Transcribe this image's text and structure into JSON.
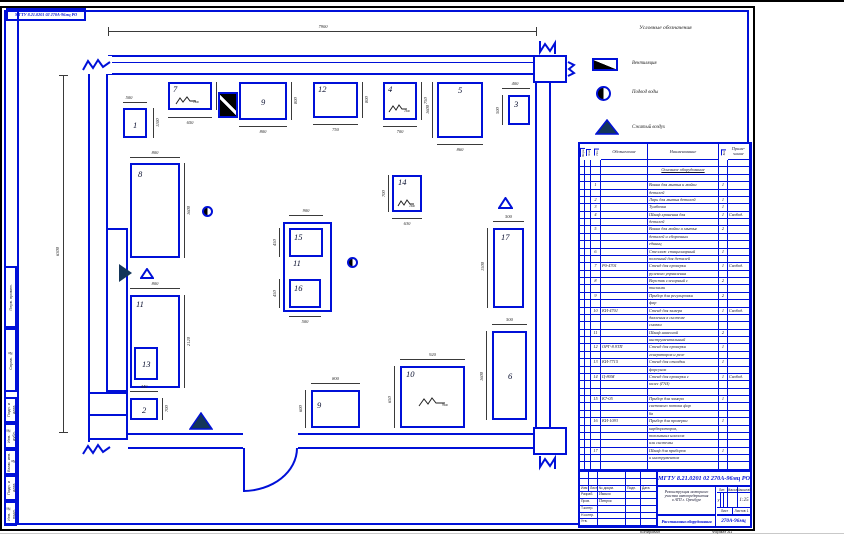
{
  "sheet": {
    "corner_stamp": "МГТУ 8.21.0201 02 270А-96мц РО",
    "footer_copy": "Копировал",
    "footer_format": "Формат А1",
    "side_upper": [
      "Перв. примен.",
      "Справ. №"
    ],
    "side_lower": [
      "Подп. и дата",
      "Инв. № дубл.",
      "Взам. инв. №",
      "Подп. и дата",
      "Инв. № подл."
    ]
  },
  "legend": {
    "title": "Условные обозначения",
    "items": [
      {
        "icon": "sink-symbol",
        "label": "Вентиляция"
      },
      {
        "icon": "water-supply-symbol",
        "label": "Подвод воды"
      },
      {
        "icon": "compressed-air-symbol",
        "label": "Сжатый воздух"
      },
      {
        "icon": "fire-extinguisher-symbol",
        "label": "Огнетушитель"
      },
      {
        "icon": "power-consumer-symbol",
        "label": "Потребители электроэнергии"
      }
    ]
  },
  "plan": {
    "dim_top": "7900",
    "dim_left": "6300",
    "items": {
      "i1": {
        "num": "1",
        "dim_top": "500",
        "dim_right": "1100"
      },
      "i7": {
        "num": "7",
        "power": "1кв",
        "dim_bottom": "650",
        "dim_right": "750"
      },
      "i9t": {
        "num": "9",
        "dim_bottom": "800",
        "dim_right": "800"
      },
      "i12": {
        "num": "12",
        "dim_bottom": "750",
        "dim_right": "800"
      },
      "i4": {
        "num": "4",
        "power": "1кв",
        "dim_bottom": "700",
        "dim_right": "750"
      },
      "i5": {
        "num": "5",
        "dim_bottom": "860",
        "dim_left": "1600"
      },
      "i3": {
        "num": "3",
        "dim_top": "400",
        "dim_left": "500"
      },
      "i8": {
        "num": "8",
        "dim_top": "800",
        "dim_right": "1600"
      },
      "i11L": {
        "num": "11",
        "dim_top": "800",
        "dim_right": "2120"
      },
      "i13": {
        "num": "13"
      },
      "i2": {
        "num": "2",
        "dim_top": "440",
        "dim_right": "700"
      },
      "i11C": {
        "num": "11",
        "dim_top": "900",
        "dim_bottom": "500"
      },
      "i15": {
        "num": "15",
        "dim_left": "450"
      },
      "i16": {
        "num": "16",
        "dim_left": "450"
      },
      "i14": {
        "num": "14",
        "power": "1кв",
        "dim_left": "700",
        "dim_bottom": "630"
      },
      "i17": {
        "num": "17",
        "dim_top": "500",
        "dim_left": "1500"
      },
      "i6": {
        "num": "6",
        "dim_top": "500",
        "dim_left": "1600"
      },
      "i9b": {
        "num": "9",
        "dim_top": "800",
        "dim_left": "600"
      },
      "i10": {
        "num": "10",
        "power": "9кв",
        "dim_top": "920",
        "dim_left": "650"
      }
    }
  },
  "spec_table": {
    "headers": {
      "c1": "Форм.",
      "c2": "Зона",
      "c3": "Поз.",
      "code": "Обозначение",
      "name": "Наименование",
      "qty": "Кол.",
      "note": "Приме-чание"
    },
    "rows": [
      {},
      {
        "section": "Основное оборудование"
      },
      {},
      {
        "p": "1",
        "n": "Ванна для мытья и мойки",
        "q": "1"
      },
      {
        "n": "деталей"
      },
      {
        "p": "2",
        "n": "Ларь для мытья деталей",
        "q": "1"
      },
      {
        "p": "3",
        "n": "Тумбочка",
        "q": "1"
      },
      {
        "p": "4",
        "n": "Шкаф хранения для",
        "q": "1",
        "t": "Свобод."
      },
      {
        "n": "деталей"
      },
      {
        "p": "5",
        "n": "Ванна для мойки и мытья",
        "q": "2"
      },
      {
        "n": "деталей и сборочных"
      },
      {
        "n": "единиц"
      },
      {
        "p": "6",
        "n": "Стеллаж стационарный",
        "q": "1"
      },
      {
        "n": "полочный для деталей"
      },
      {
        "p": "7",
        "c": "Р0-4701",
        "n": "Стенд для проверки",
        "q": "1",
        "t": "Свобод."
      },
      {
        "n": "рулевого управления"
      },
      {
        "p": "8",
        "n": "Верстак слесарный с",
        "q": "2"
      },
      {
        "n": "тисками"
      },
      {
        "p": "9",
        "n": "Прибор для регулировки",
        "q": "2"
      },
      {
        "n": "фар"
      },
      {
        "p": "10",
        "c": "КИ-4701",
        "n": "Стенд для замера",
        "q": "1",
        "t": "Свобод."
      },
      {
        "n": "давления в системе"
      },
      {
        "n": "смазки"
      },
      {
        "p": "11",
        "n": "Шкаф навесной",
        "q": "2"
      },
      {
        "n": "инструментальный"
      },
      {
        "p": "12",
        "c": "ОРГ-8.9ТП",
        "n": "Стенд для проверки",
        "q": "1"
      },
      {
        "n": "генераторов и реле"
      },
      {
        "p": "13",
        "c": "КИ-7715",
        "n": "Стенд для отладки",
        "q": "1"
      },
      {
        "n": "форсунок"
      },
      {
        "p": "14",
        "c": "Ц-80М",
        "n": "Стенд для проверки с",
        "q": "1",
        "t": "Свобод."
      },
      {
        "n": "колес (ГАЗ)"
      },
      {},
      {
        "p": "15",
        "c": "К7-05",
        "n": "Прибор для замера",
        "q": "1"
      },
      {
        "n": "светового потока фар"
      },
      {
        "n": "6в"
      },
      {
        "p": "16",
        "c": "КИ-1093",
        "n": "Прибор для проверки",
        "q": "1"
      },
      {
        "n": "карбюраторов,"
      },
      {
        "n": "топливных насосов"
      },
      {
        "n": "или системы"
      },
      {
        "p": "17",
        "n": "Шкаф для приборов",
        "q": "1"
      },
      {
        "n": "и инструментов"
      },
      {}
    ]
  },
  "title_block": {
    "doc_number": "МГТУ 8.21.0201 02 270А-96мц РО",
    "description": [
      "Реконструкция моторного",
      "участка автопредприятия",
      "в АТП г. Оренбург"
    ],
    "doc_title": "Расстановка оборудования",
    "group": "270А-96мц",
    "lit_label": "Лит.",
    "lit_value": "у",
    "mass_label": "Масса",
    "scale_label": "Масштаб",
    "scale_value": "1:25",
    "sheet_label": "Лист",
    "sheets_label": "Листов",
    "sheets_value": "1",
    "sig_rows": [
      [
        "Изм",
        "Лист",
        "№ докум.",
        "Подп.",
        "Дата"
      ],
      [
        "Разраб.",
        "Иванов"
      ],
      [
        "Пров.",
        "Петров"
      ],
      [
        "Т.контр.",
        ""
      ],
      [
        "Н.контр.",
        ""
      ],
      [
        "Утв.",
        ""
      ]
    ]
  }
}
